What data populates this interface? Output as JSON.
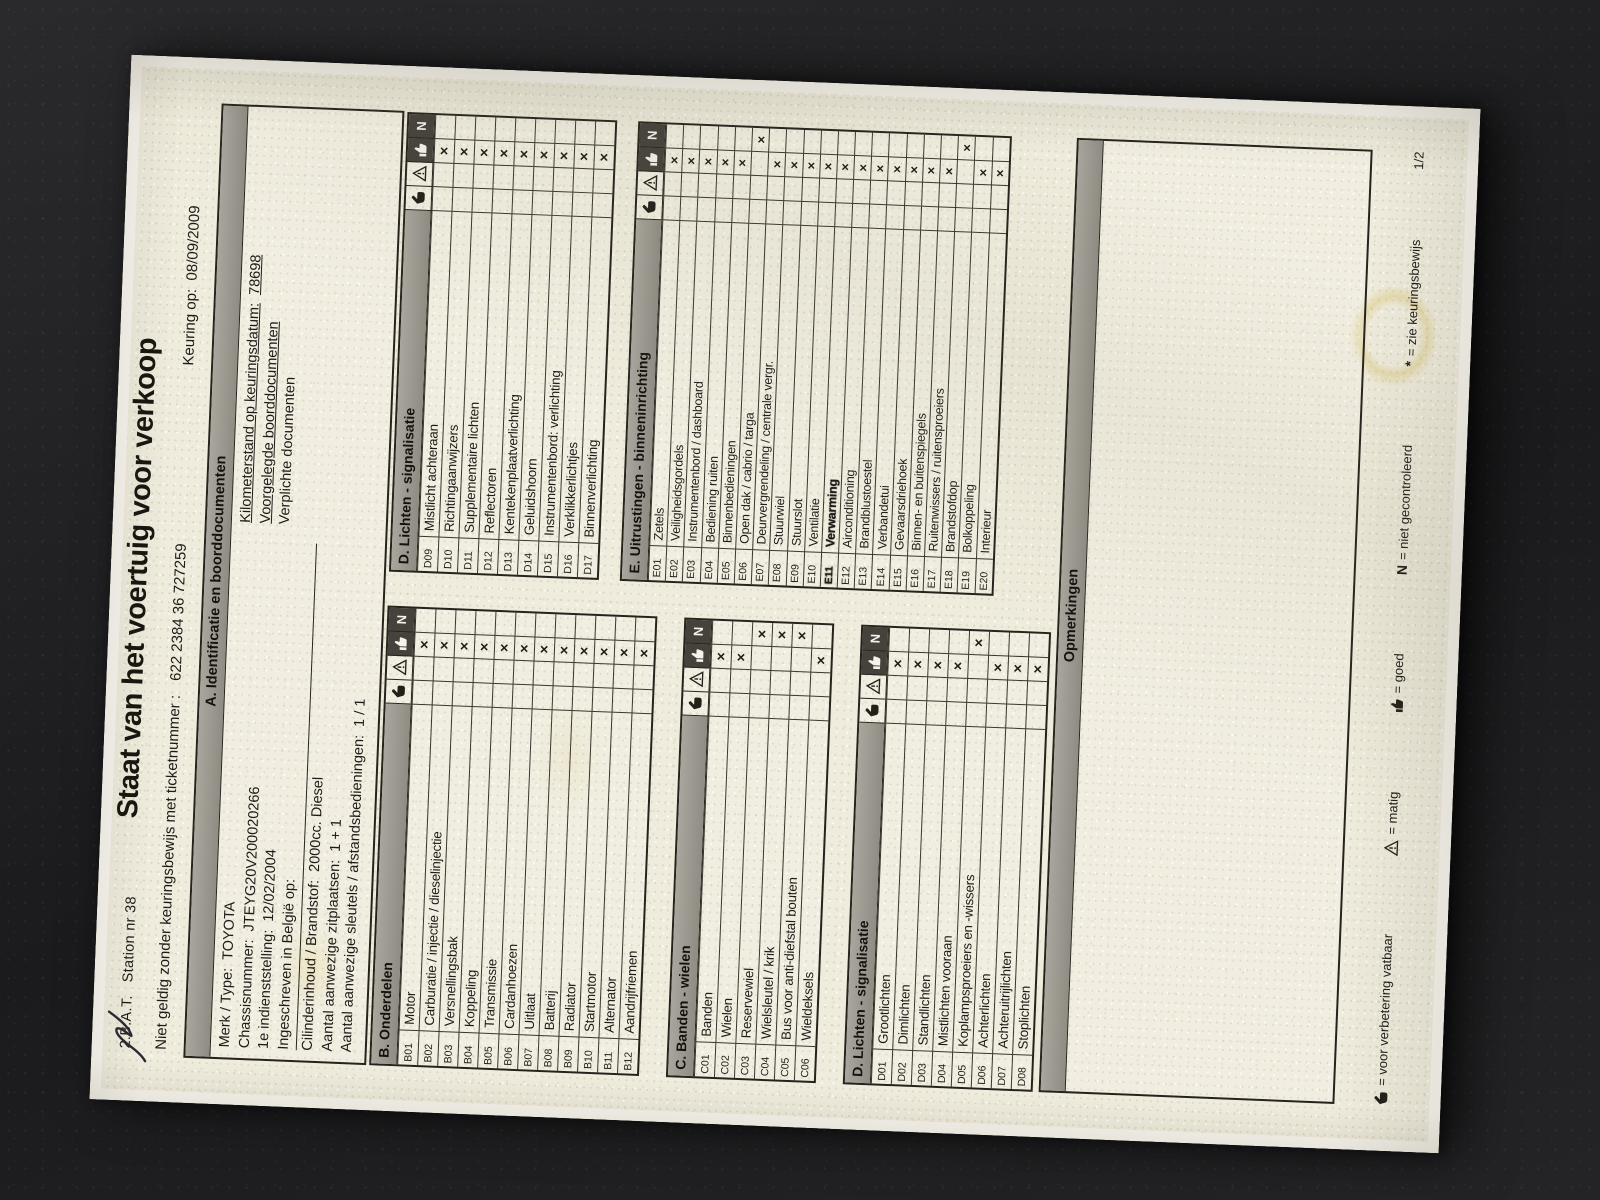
{
  "header": {
    "station": "2.B.A.T.   Station nr 38",
    "title": "Staat van het voertuig voor verkoop",
    "ticket_label": "Niet geldig zonder keuringsbewijs met ticketnummer :",
    "ticket_number": "622 2384 36 727259",
    "keuring_label": "Keuring op:",
    "keuring_date": "08/09/2009"
  },
  "section_a": {
    "title": "A. Identificatie en boorddocumenten",
    "left": [
      {
        "label": "Merk / Type:",
        "value": "TOYOTA"
      },
      {
        "label": "Chassisnummer:",
        "value": "JTEYG20V200020266"
      },
      {
        "label": "1e indienststelling:",
        "value": "12/02/2004"
      },
      {
        "label": "Ingeschreven in België op:",
        "value": ""
      }
    ],
    "right": [
      {
        "label": "Kilometerstand op keuringsdatum:",
        "value": "78698",
        "underline": true
      },
      {
        "label": "Voorgelegde boorddocumenten",
        "value": "",
        "underline": true
      },
      {
        "label": "Verplichte documenten",
        "value": "",
        "underline": false
      }
    ],
    "bottom": [
      {
        "label": "Cilinderinhoud / Brandstof:",
        "value": "2000cc. Diesel"
      },
      {
        "label": "Aantal aanwezige zitplaatsen:",
        "value": "1 + 1"
      },
      {
        "label": "Aantal aanwezige sleutels / afstandsbedieningen:",
        "value": "1 / 1"
      }
    ]
  },
  "mark_columns": [
    {
      "id": "hand",
      "meaning": "voor verbetering vatbaar"
    },
    {
      "id": "triangle",
      "meaning": "matig"
    },
    {
      "id": "thumb",
      "meaning": "goed"
    },
    {
      "id": "N",
      "meaning": "niet gecontroleerd"
    }
  ],
  "tables": {
    "B": {
      "title": "B. Onderdelen",
      "style": "std",
      "rows": [
        {
          "code": "B01",
          "label": "Motor",
          "mark": "thumb"
        },
        {
          "code": "B02",
          "label": "Carburatie / injectie / dieselinjectie",
          "mark": "thumb"
        },
        {
          "code": "B03",
          "label": "Versnellingsbak",
          "mark": "thumb"
        },
        {
          "code": "B04",
          "label": "Koppeling",
          "mark": "thumb"
        },
        {
          "code": "B05",
          "label": "Transmissie",
          "mark": "thumb"
        },
        {
          "code": "B06",
          "label": "Cardanhoezen",
          "mark": "thumb"
        },
        {
          "code": "B07",
          "label": "Uitlaat",
          "mark": "thumb"
        },
        {
          "code": "B08",
          "label": "Batterij",
          "mark": "thumb"
        },
        {
          "code": "B09",
          "label": "Radiator",
          "mark": "thumb"
        },
        {
          "code": "B10",
          "label": "Startmotor",
          "mark": "thumb"
        },
        {
          "code": "B11",
          "label": "Alternator",
          "mark": "thumb"
        },
        {
          "code": "B12",
          "label": "Aandrijfriemen",
          "mark": "thumb"
        }
      ]
    },
    "C": {
      "title": "C. Banden - wielen",
      "style": "std",
      "rows": [
        {
          "code": "C01",
          "label": "Banden",
          "mark": "thumb"
        },
        {
          "code": "C02",
          "label": "Wielen",
          "mark": "thumb"
        },
        {
          "code": "C03",
          "label": "Reservewiel",
          "mark": "N"
        },
        {
          "code": "C04",
          "label": "Wielsleutel / krik",
          "mark": "N"
        },
        {
          "code": "C05",
          "label": "Bus voor anti-diefstal bouten",
          "mark": "N"
        },
        {
          "code": "C06",
          "label": "Wieldeksels",
          "mark": "thumb"
        }
      ]
    },
    "D1": {
      "title": "D. Lichten - signalisatie",
      "style": "std",
      "rows": [
        {
          "code": "D01",
          "label": "Grootlichten",
          "mark": "thumb"
        },
        {
          "code": "D02",
          "label": "Dimlichten",
          "mark": "thumb"
        },
        {
          "code": "D03",
          "label": "Standlichten",
          "mark": "thumb"
        },
        {
          "code": "D04",
          "label": "Mistlichten vooraan",
          "mark": "thumb"
        },
        {
          "code": "D05",
          "label": "Koplampsproeiers en -wissers",
          "mark": "N"
        },
        {
          "code": "D06",
          "label": "Achterlichten",
          "mark": "thumb"
        },
        {
          "code": "D07",
          "label": "Achteruitrijlichten",
          "mark": "thumb"
        },
        {
          "code": "D08",
          "label": "Stoplichten",
          "mark": "thumb"
        }
      ]
    },
    "D2": {
      "title": "D. Lichten - signalisatie",
      "style": "std",
      "rows": [
        {
          "code": "D09",
          "label": "Mistlicht achteraan",
          "mark": "thumb"
        },
        {
          "code": "D10",
          "label": "Richtingaanwijzers",
          "mark": "thumb"
        },
        {
          "code": "D11",
          "label": "Supplementaire lichten",
          "mark": "thumb"
        },
        {
          "code": "D12",
          "label": "Reflectoren",
          "mark": "thumb"
        },
        {
          "code": "D13",
          "label": "Kentekenplaatverlichting",
          "mark": "thumb"
        },
        {
          "code": "D14",
          "label": "Geluidshoorn",
          "mark": "thumb"
        },
        {
          "code": "D15",
          "label": "Instrumentenbord: verlichting",
          "mark": "thumb"
        },
        {
          "code": "D16",
          "label": "Verklikkerlichtjes",
          "mark": "thumb"
        },
        {
          "code": "D17",
          "label": "Binnenverlichting",
          "mark": "thumb"
        }
      ]
    },
    "E": {
      "title": "E. Uitrustingen - binneninrichting",
      "style": "e",
      "rows": [
        {
          "code": "E01",
          "label": "Zetels",
          "mark": "thumb"
        },
        {
          "code": "E02",
          "label": "Veiligheidsgordels",
          "mark": "thumb"
        },
        {
          "code": "E03",
          "label": "Instrumentenbord / dashboard",
          "mark": "thumb"
        },
        {
          "code": "E04",
          "label": "Bediening ruiten",
          "mark": "thumb"
        },
        {
          "code": "E05",
          "label": "Binnenbedieningen",
          "mark": "thumb"
        },
        {
          "code": "E06",
          "label": "Open dak / cabrio / targa",
          "mark": "N"
        },
        {
          "code": "E07",
          "label": "Deurvergrendeling / centrale vergr.",
          "mark": "thumb"
        },
        {
          "code": "E08",
          "label": "Stuurwiel",
          "mark": "thumb"
        },
        {
          "code": "E09",
          "label": "Stuurslot",
          "mark": "thumb"
        },
        {
          "code": "E10",
          "label": "Ventilatie",
          "mark": "thumb"
        },
        {
          "code": "E11",
          "label": "Verwarming",
          "mark": "thumb",
          "emph": true
        },
        {
          "code": "E12",
          "label": "Airconditioning",
          "mark": "thumb"
        },
        {
          "code": "E13",
          "label": "Brandblustoestel",
          "mark": "thumb"
        },
        {
          "code": "E14",
          "label": "Verbandetui",
          "mark": "thumb"
        },
        {
          "code": "E15",
          "label": "Gevaarsdriehoek",
          "mark": "thumb"
        },
        {
          "code": "E16",
          "label": "Binnen- en buitenspiegels",
          "mark": "thumb"
        },
        {
          "code": "E17",
          "label": "Ruitenwissers / ruitensproeiers",
          "mark": "thumb"
        },
        {
          "code": "E18",
          "label": "Brandstofdop",
          "mark": "N"
        },
        {
          "code": "E19",
          "label": "Bolkoppeling",
          "mark": "thumb"
        },
        {
          "code": "E20",
          "label": "Interieur",
          "mark": "thumb"
        }
      ]
    }
  },
  "opmerkingen": {
    "title": "Opmerkingen",
    "content": ""
  },
  "legend": {
    "items": [
      {
        "icon": "hand",
        "text": "= voor verbetering vatbaar"
      },
      {
        "icon": "triangle",
        "text": "= matig"
      },
      {
        "icon": "thumb",
        "text": "= goed"
      },
      {
        "icon": "letter-n",
        "text": "= niet gecontroleerd"
      },
      {
        "icon": "asterisk",
        "text": "= zie keuringsbewijs"
      }
    ]
  },
  "footer": {
    "page_number": "1/2"
  },
  "colors": {
    "paper": "#efecdd",
    "header_bar_gray": "#9b9990",
    "dark_cell": "#45423c",
    "ink": "#26231d",
    "background": "#1e1e20"
  }
}
